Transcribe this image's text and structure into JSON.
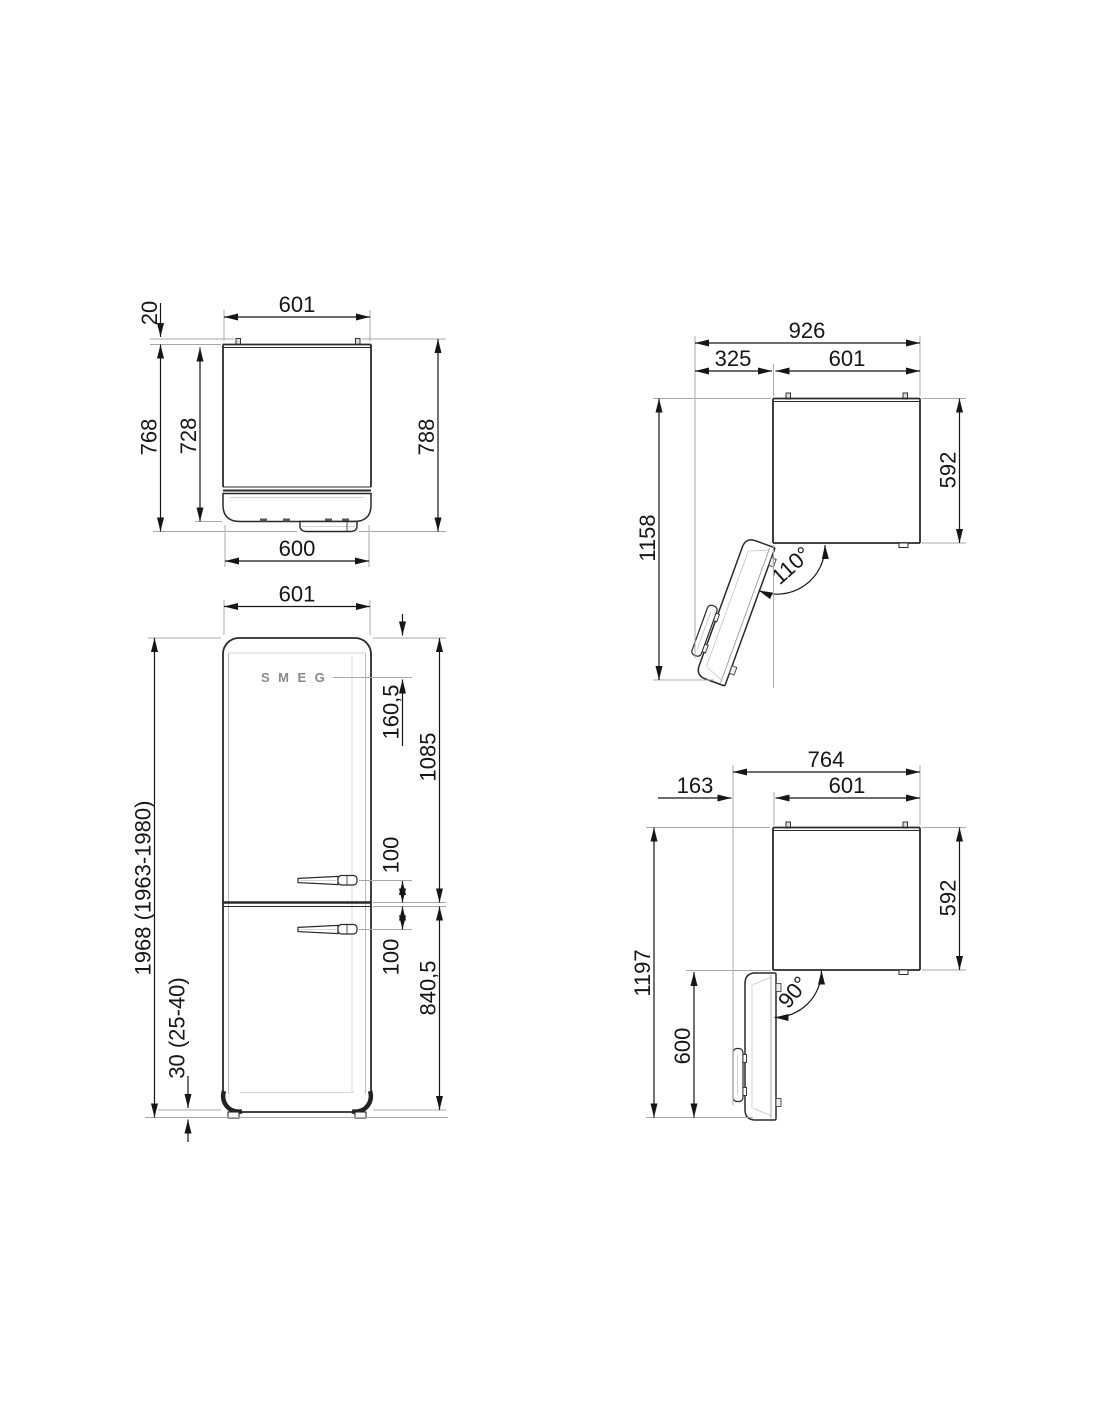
{
  "page": {
    "background": "#ffffff",
    "line_color": "#2a2a2a",
    "extension_line_color": "#a8a8a8",
    "text_color": "#161616"
  },
  "brand": {
    "logo": "SMEG"
  },
  "views": {
    "top": {
      "cabinet_width": "601",
      "wall_spacer": "20",
      "depth_body": "728",
      "depth_door": "768",
      "depth_total": "788",
      "door_width": "600"
    },
    "front": {
      "width": "601",
      "logo_offset": "160,5",
      "fridge_door_height": "1085",
      "handle_above_split": "100",
      "handle_below_split": "100",
      "freezer_door_height": "840,5",
      "total_height": "1968 (1963-1980)",
      "plinth_height": "30 (25-40)"
    },
    "open110": {
      "overall_width": "926",
      "door_swing": "325",
      "width": "601",
      "depth": "592",
      "overall_depth": "1158",
      "angle": "110°"
    },
    "open90": {
      "overall_width": "764",
      "door_swing": "163",
      "width": "601",
      "depth": "592",
      "overall_depth": "1197",
      "door_length": "600",
      "angle": "90°"
    }
  }
}
